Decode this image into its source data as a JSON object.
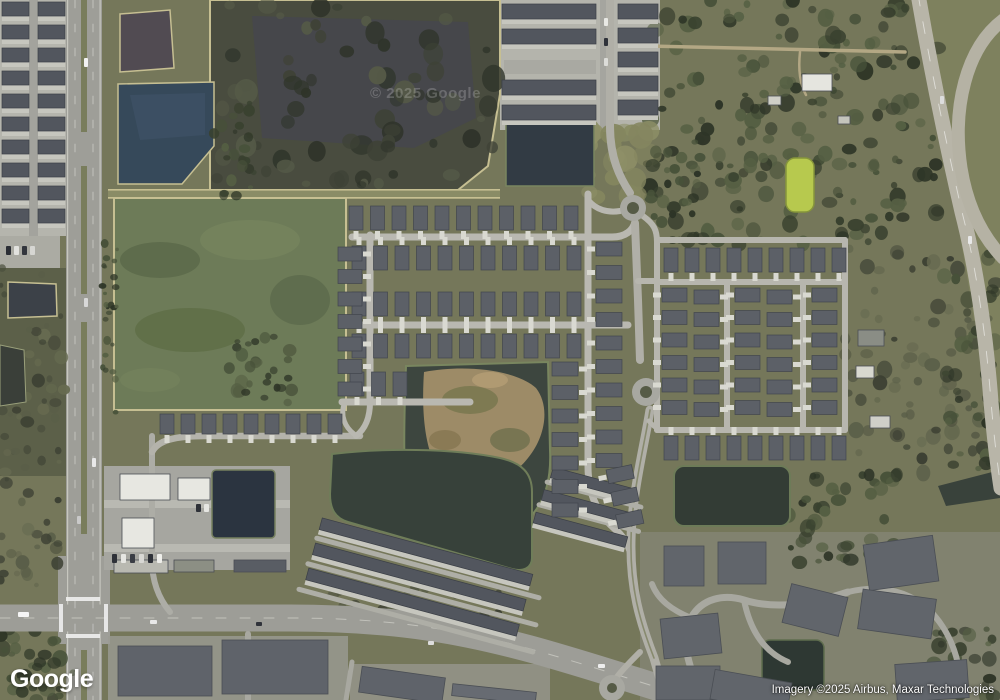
{
  "map_ui": {
    "logo": "Google",
    "watermark": "© 2025 Google",
    "attribution": "Imagery ©2025 Airbus, Maxar Technologies",
    "view_type": "satellite"
  },
  "colors": {
    "grass": "#75775a",
    "forest": "#39412f",
    "marsh_water": "#45474e",
    "pond_blue": "#36495a",
    "pond_green": "#6d7b58",
    "pond_dark": "#37413a",
    "pond_navy": "#2b3440",
    "pond_lime": "#b7c94e",
    "berm_khaki": "#c6bf92",
    "road": "#9d9d97",
    "street": "#b9b8b1",
    "dirt_road": "#b3a784",
    "roof": "#5c6067",
    "townhouse_roof": "#52565e",
    "white_building": "#e7e7e1",
    "concrete": "#b5b5ad",
    "dirt_island": "#9d8b67"
  },
  "map_objects": {
    "house_rows": [
      {
        "x": 349,
        "y": 206,
        "n": 11,
        "dx": 21.5,
        "w": 14,
        "h": 24,
        "drive": "s"
      },
      {
        "x": 352,
        "y": 246,
        "n": 11,
        "dx": 21.5,
        "w": 14,
        "h": 24,
        "drive": "n"
      },
      {
        "x": 352,
        "y": 292,
        "n": 11,
        "dx": 21.5,
        "w": 14,
        "h": 24,
        "drive": "s"
      },
      {
        "x": 352,
        "y": 334,
        "n": 11,
        "dx": 21.5,
        "w": 14,
        "h": 24,
        "drive": "n"
      },
      {
        "x": 350,
        "y": 372,
        "n": 3,
        "dx": 21.5,
        "w": 14,
        "h": 24,
        "drive": "s"
      },
      {
        "x": 160,
        "y": 414,
        "n": 9,
        "dx": 21,
        "w": 14,
        "h": 20,
        "drive": "s"
      },
      {
        "x": 338,
        "y": 247,
        "n": 7,
        "dy": 22.5,
        "w": 24,
        "h": 14,
        "drive": "e"
      },
      {
        "x": 596,
        "y": 242,
        "n": 10,
        "dy": 23.5,
        "w": 26,
        "h": 14,
        "drive": "w"
      },
      {
        "x": 552,
        "y": 362,
        "n": 7,
        "dy": 23.5,
        "w": 26,
        "h": 14,
        "drive": "e"
      },
      {
        "x": 606,
        "y": 470,
        "n": 3,
        "dy": 23,
        "w": 26,
        "h": 14,
        "drive": "w",
        "rot": [
          -12,
          606,
          470
        ]
      },
      {
        "x": 664,
        "y": 248,
        "n": 9,
        "dx": 21,
        "w": 14,
        "h": 24,
        "drive": "s"
      },
      {
        "x": 664,
        "y": 436,
        "n": 9,
        "dx": 21,
        "w": 14,
        "h": 24,
        "drive": "n"
      },
      {
        "x": 662,
        "y": 288,
        "n": 6,
        "dy": 22.5,
        "w": 25,
        "h": 14,
        "drive": "w"
      },
      {
        "x": 694,
        "y": 290,
        "n": 6,
        "dy": 22.5,
        "w": 25,
        "h": 14,
        "drive": "e"
      },
      {
        "x": 735,
        "y": 288,
        "n": 6,
        "dy": 22.5,
        "w": 25,
        "h": 14,
        "drive": "w"
      },
      {
        "x": 767,
        "y": 290,
        "n": 6,
        "dy": 22.5,
        "w": 25,
        "h": 14,
        "drive": "e"
      },
      {
        "x": 812,
        "y": 288,
        "n": 6,
        "dy": 22.5,
        "w": 25,
        "h": 14,
        "drive": "w"
      }
    ],
    "strips": [
      {
        "x": 2,
        "y": 2,
        "w": 27,
        "h": 14,
        "n": 10,
        "dy": 23
      },
      {
        "x": 38,
        "y": 2,
        "w": 27,
        "h": 14,
        "n": 10,
        "dy": 23
      },
      {
        "x": 502,
        "y": 4,
        "w": 94,
        "h": 15,
        "n": 2,
        "dy": 25
      },
      {
        "x": 502,
        "y": 80,
        "w": 94,
        "h": 15,
        "n": 2,
        "dy": 25
      },
      {
        "x": 618,
        "y": 4,
        "w": 40,
        "h": 15,
        "n": 5,
        "dy": 24
      },
      {
        "x": 322,
        "y": 520,
        "w": 218,
        "h": 12,
        "n": 3,
        "dy": 26,
        "rot": [
          15,
          330,
          520
        ]
      },
      {
        "x": 545,
        "y": 470,
        "w": 80,
        "h": 11,
        "n": 1,
        "rot": [
          15,
          560,
          500
        ]
      },
      {
        "x": 542,
        "y": 494,
        "w": 88,
        "h": 11,
        "n": 1,
        "rot": [
          15,
          560,
          500
        ]
      },
      {
        "x": 540,
        "y": 518,
        "w": 95,
        "h": 11,
        "n": 1,
        "rot": [
          15,
          560,
          500
        ]
      }
    ],
    "buildings": [
      {
        "x": 120,
        "y": 474,
        "w": 50,
        "h": 26,
        "fill": "#e7e7e1"
      },
      {
        "x": 178,
        "y": 478,
        "w": 32,
        "h": 22,
        "fill": "#e7e7e1"
      },
      {
        "x": 122,
        "y": 518,
        "w": 32,
        "h": 30,
        "fill": "#e7e7e1"
      },
      {
        "x": 114,
        "y": 560,
        "w": 54,
        "h": 13,
        "fill": "#b9b9b1"
      },
      {
        "x": 174,
        "y": 560,
        "w": 40,
        "h": 12,
        "fill": "#8c8f84"
      },
      {
        "x": 234,
        "y": 560,
        "w": 52,
        "h": 12,
        "fill": "#595d64"
      },
      {
        "x": 118,
        "y": 646,
        "w": 94,
        "h": 50,
        "fill": "#5f636a"
      },
      {
        "x": 222,
        "y": 640,
        "w": 106,
        "h": 54,
        "fill": "#5f636a"
      },
      {
        "x": 360,
        "y": 672,
        "w": 84,
        "h": 26,
        "rot": 8,
        "fill": "#5f636a"
      },
      {
        "x": 452,
        "y": 688,
        "w": 84,
        "h": 12,
        "rot": 6,
        "fill": "#676b72"
      },
      {
        "x": 664,
        "y": 546,
        "w": 40,
        "h": 40,
        "fill": "#61656b"
      },
      {
        "x": 718,
        "y": 542,
        "w": 48,
        "h": 42,
        "fill": "#61656b"
      },
      {
        "x": 866,
        "y": 540,
        "w": 70,
        "h": 46,
        "rot": -8,
        "fill": "#61656b"
      },
      {
        "x": 786,
        "y": 590,
        "w": 58,
        "h": 40,
        "rot": 14,
        "fill": "#61656b"
      },
      {
        "x": 662,
        "y": 616,
        "w": 58,
        "h": 40,
        "rot": -6,
        "fill": "#61656b"
      },
      {
        "x": 860,
        "y": 594,
        "w": 74,
        "h": 40,
        "rot": 8,
        "fill": "#61656b"
      },
      {
        "x": 656,
        "y": 666,
        "w": 64,
        "h": 34,
        "fill": "#61656b"
      },
      {
        "x": 712,
        "y": 676,
        "w": 78,
        "h": 30,
        "rot": 10,
        "fill": "#61656b"
      },
      {
        "x": 896,
        "y": 662,
        "w": 72,
        "h": 38,
        "rot": -4,
        "fill": "#61656b"
      },
      {
        "x": 802,
        "y": 74,
        "w": 30,
        "h": 17,
        "fill": "#e5e5df"
      },
      {
        "x": 768,
        "y": 96,
        "w": 13,
        "h": 9,
        "fill": "#cfcfc7"
      },
      {
        "x": 838,
        "y": 116,
        "w": 12,
        "h": 8,
        "fill": "#c4c4bc"
      },
      {
        "x": 858,
        "y": 330,
        "w": 26,
        "h": 16,
        "fill": "#8a8d85"
      },
      {
        "x": 856,
        "y": 366,
        "w": 18,
        "h": 12,
        "fill": "#d8d8d0"
      },
      {
        "x": 870,
        "y": 416,
        "w": 20,
        "h": 12,
        "fill": "#cfcfc8"
      }
    ],
    "cars": [
      [
        84,
        58,
        4,
        9,
        "#f2f2f2"
      ],
      [
        84,
        298,
        4,
        9,
        "#d8d8d8"
      ],
      [
        92,
        458,
        4,
        9,
        "#e8e8e8"
      ],
      [
        77,
        516,
        4,
        8,
        "#c9c9c9"
      ],
      [
        18,
        612,
        11,
        5,
        "#f5f5f5"
      ],
      [
        150,
        620,
        7,
        4,
        "#e8e8e8"
      ],
      [
        256,
        622,
        6,
        4,
        "#30333a"
      ],
      [
        428,
        641,
        6,
        4,
        "#dddddd"
      ],
      [
        598,
        664,
        7,
        4,
        "#eeeeee"
      ],
      [
        112,
        554,
        5,
        9,
        "#2e3138"
      ],
      [
        121,
        554,
        5,
        9,
        "#e6e6e2"
      ],
      [
        130,
        554,
        5,
        9,
        "#3a3d44"
      ],
      [
        139,
        554,
        5,
        9,
        "#d8d8d4"
      ],
      [
        148,
        554,
        5,
        9,
        "#2e3138"
      ],
      [
        157,
        554,
        5,
        9,
        "#eeeeea"
      ],
      [
        196,
        504,
        5,
        8,
        "#2e3138"
      ],
      [
        204,
        504,
        5,
        8,
        "#e6e6e2"
      ],
      [
        6,
        246,
        5,
        9,
        "#2b2e35"
      ],
      [
        14,
        246,
        5,
        9,
        "#e2e2de"
      ],
      [
        22,
        246,
        5,
        9,
        "#33363d"
      ],
      [
        30,
        246,
        5,
        9,
        "#d6d6d2"
      ],
      [
        604,
        18,
        4,
        8,
        "#e8e8e4"
      ],
      [
        604,
        38,
        4,
        8,
        "#2f323a"
      ],
      [
        604,
        58,
        4,
        8,
        "#dcdcd8"
      ],
      [
        968,
        236,
        4,
        8,
        "#e8e8e8"
      ],
      [
        940,
        96,
        4,
        8,
        "#dddddd"
      ]
    ]
  }
}
